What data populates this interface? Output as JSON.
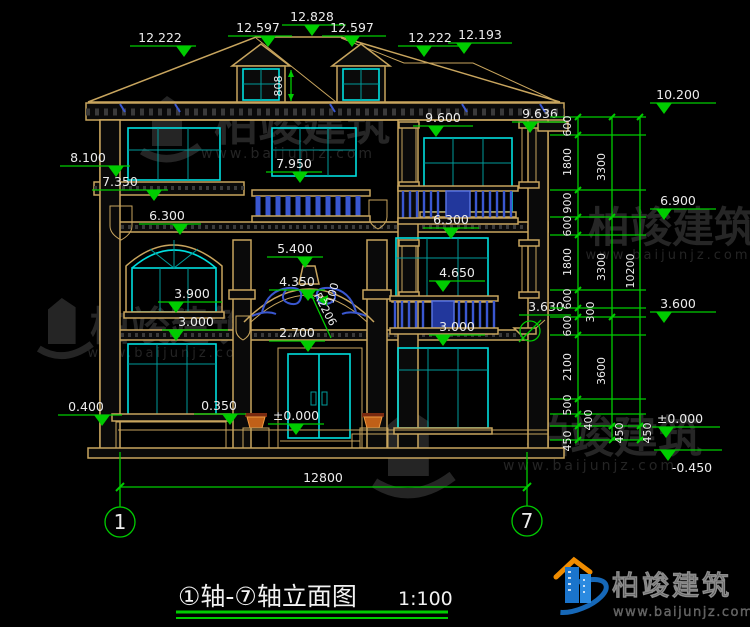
{
  "title": {
    "main": "①轴-⑦轴立面图",
    "scale": "1:100"
  },
  "axis": {
    "left_bubble": "1",
    "right_bubble": "7",
    "overall_width": "12800"
  },
  "roof_marks": {
    "left_hip": "12.222",
    "left_ridge_end": "12.597",
    "ridge": "12.828",
    "right_ridge_end": "12.597",
    "right_hip": "12.222",
    "right_lower_ridge": "12.193",
    "dormer_height": "808"
  },
  "left_marks": {
    "wing_cornice": "8.100",
    "wing_cornice_bottom": "7.350",
    "arch_window_top": "6.300",
    "arch_window_sill": "3.900",
    "lower_window_top": "3.000",
    "plinth_top": "0.400",
    "lower_window_sill": "0.350"
  },
  "center_marks": {
    "balustrade_top": "7.950",
    "porch_ceiling": "5.400",
    "arch_top": "4.350",
    "arch_radius": "R2206",
    "arch_offset": "100",
    "door_top": "2.700",
    "entry_level": "±0.000"
  },
  "right_marks": {
    "eave_bottom": "9.600",
    "cornice": "9.636",
    "balcony_top": "6.300",
    "window_sill_2f": "4.650",
    "balcony_floor": "3.000",
    "bracket_detail": "3.630"
  },
  "elevation_flags": {
    "eave": "10.200",
    "floor3": "6.900",
    "floor2": "3.600",
    "ground": "±0.000",
    "site": "-0.450"
  },
  "chain_a": {
    "s1": "600",
    "s2": "1800",
    "s3": "900",
    "s4": "600",
    "s5": "1800",
    "s6": "600",
    "s7": "300",
    "s8": "600",
    "s9": "2100",
    "s10": "500",
    "s11": "400",
    "s12": "450"
  },
  "chain_b": {
    "s1": "3300",
    "s2": "3300",
    "s3": "3600",
    "s4": "450"
  },
  "chain_c": {
    "total": "10200",
    "s2": "450"
  },
  "watermark": {
    "name": "柏竣建筑",
    "url": "www.baijunjz.com"
  },
  "logo": {
    "name": "柏竣建筑",
    "url": "www.baijunjz.com"
  },
  "colors": {
    "dimension_green": "#00cc00",
    "outline_tan": "#c8a55e",
    "window_cyan": "#00dede",
    "railing_blue": "#3a57d0",
    "logo_blue": "#1a74cc",
    "logo_orange": "#f08c00"
  }
}
